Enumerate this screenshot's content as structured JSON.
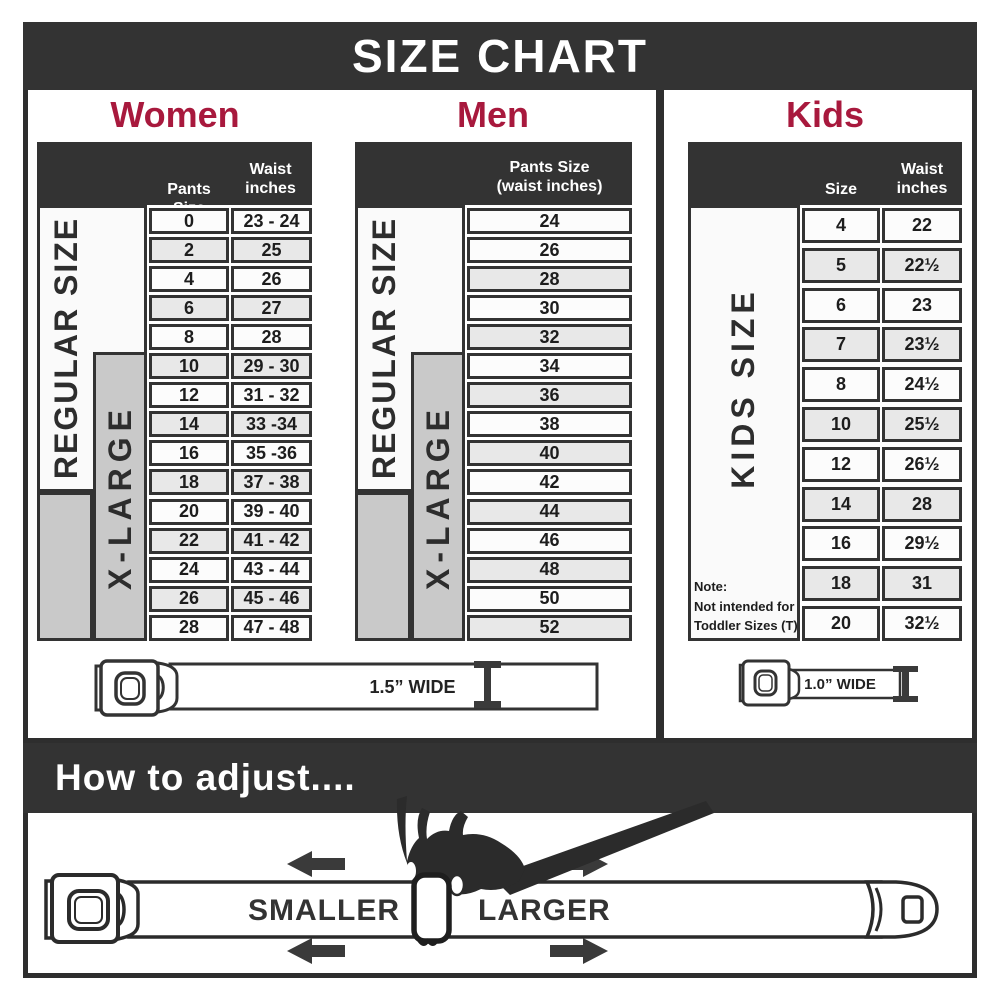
{
  "title": "SIZE CHART",
  "colors": {
    "dark_bar": "#333333",
    "accent_red": "#a8193d",
    "band_gray": "#c9c9c9",
    "row_shaded": "#e8e8e8",
    "row_plain": "#fcfcfc"
  },
  "women": {
    "heading": "Women",
    "col1_header": "Pants Size",
    "col2_header_line1": "Waist",
    "col2_header_line2": "inches",
    "regular_label": "REGULAR SIZE",
    "xlarge_label": "X-LARGE"
  },
  "men": {
    "heading": "Men",
    "col_header_line1": "Pants Size",
    "col_header_line2": "(waist inches)",
    "regular_label": "REGULAR SIZE",
    "xlarge_label": "X-LARGE"
  },
  "kids": {
    "heading": "Kids",
    "col1_header": "Size",
    "col2_header_line1": "Waist",
    "col2_header_line2": "inches",
    "band_label": "KIDS SIZE",
    "note_line1": "Note:",
    "note_line2": "Not intended for",
    "note_line3": "Toddler Sizes (T)"
  },
  "belts": {
    "adult_width_label": "1.5” WIDE",
    "kids_width_label": "1.0” WIDE"
  },
  "adjust": {
    "heading": "How to adjust....",
    "smaller_label": "SMALLER",
    "larger_label": "LARGER"
  },
  "chart_data": [
    {
      "type": "table",
      "name": "women",
      "title": "Women",
      "columns": [
        "Pants Size",
        "Waist inches"
      ],
      "rows": [
        [
          "0",
          "23 - 24"
        ],
        [
          "2",
          "25"
        ],
        [
          "4",
          "26"
        ],
        [
          "6",
          "27"
        ],
        [
          "8",
          "28"
        ],
        [
          "10",
          "29 - 30"
        ],
        [
          "12",
          "31 - 32"
        ],
        [
          "14",
          "33 -34"
        ],
        [
          "16",
          "35 -36"
        ],
        [
          "18",
          "37 - 38"
        ],
        [
          "20",
          "39 - 40"
        ],
        [
          "22",
          "41 - 42"
        ],
        [
          "24",
          "43 - 44"
        ],
        [
          "26",
          "45 - 46"
        ],
        [
          "28",
          "47 - 48"
        ]
      ],
      "size_bands": [
        {
          "label": "REGULAR SIZE",
          "covers_pants_sizes": "0–18"
        },
        {
          "label": "X-LARGE",
          "covers_pants_sizes": "10–28"
        }
      ],
      "belt_width": "1.5” WIDE"
    },
    {
      "type": "table",
      "name": "men",
      "title": "Men",
      "columns": [
        "Pants Size (waist inches)"
      ],
      "rows": [
        [
          "24"
        ],
        [
          "26"
        ],
        [
          "28"
        ],
        [
          "30"
        ],
        [
          "32"
        ],
        [
          "34"
        ],
        [
          "36"
        ],
        [
          "38"
        ],
        [
          "40"
        ],
        [
          "42"
        ],
        [
          "44"
        ],
        [
          "46"
        ],
        [
          "48"
        ],
        [
          "50"
        ],
        [
          "52"
        ]
      ],
      "size_bands": [
        {
          "label": "REGULAR SIZE",
          "covers_pants_sizes": "24–42"
        },
        {
          "label": "X-LARGE",
          "covers_pants_sizes": "34–52"
        }
      ],
      "belt_width": "1.5” WIDE"
    },
    {
      "type": "table",
      "name": "kids",
      "title": "Kids",
      "columns": [
        "Size",
        "Waist inches"
      ],
      "rows": [
        [
          "4",
          "22"
        ],
        [
          "5",
          "22½"
        ],
        [
          "6",
          "23"
        ],
        [
          "7",
          "23½"
        ],
        [
          "8",
          "24½"
        ],
        [
          "10",
          "25½"
        ],
        [
          "12",
          "26½"
        ],
        [
          "14",
          "28"
        ],
        [
          "16",
          "29½"
        ],
        [
          "18",
          "31"
        ],
        [
          "20",
          "32½"
        ]
      ],
      "size_bands": [
        {
          "label": "KIDS SIZE",
          "covers_sizes": "4–20"
        }
      ],
      "note": "Note: Not intended for Toddler Sizes (T)",
      "belt_width": "1.0” WIDE"
    }
  ]
}
